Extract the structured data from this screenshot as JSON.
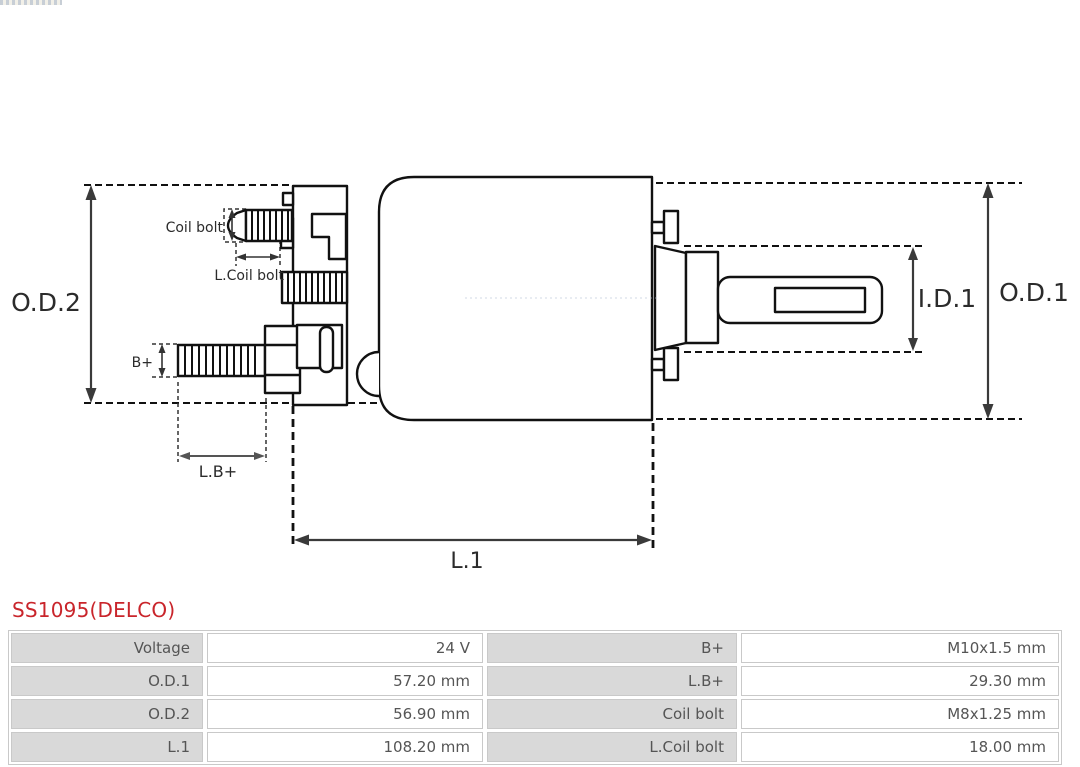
{
  "part": {
    "title": "SS1095(DELCO)",
    "title_color": "#c9252b"
  },
  "diagram": {
    "type": "starter-solenoid technical drawing",
    "labels": {
      "od2": "O.D.2",
      "od1": "O.D.1",
      "id1": "I.D.1",
      "l1": "L.1",
      "lb_plus": "L.B+",
      "b_plus": "B+",
      "coil_bolt": "Coil bolt",
      "l_coil_bolt": "L.Coil bolt"
    },
    "line_color": "#111111",
    "dimension_color": "#3a3a3a"
  },
  "specs_table": {
    "label_bg": "#d9d9d9",
    "border_color": "#c9c9c9",
    "rows": [
      {
        "label_left": "Voltage",
        "value_left": "24 V",
        "label_right": "B+",
        "value_right": "M10x1.5 mm"
      },
      {
        "label_left": "O.D.1",
        "value_left": "57.20 mm",
        "label_right": "L.B+",
        "value_right": "29.30 mm"
      },
      {
        "label_left": "O.D.2",
        "value_left": "56.90 mm",
        "label_right": "Coil bolt",
        "value_right": "M8x1.25 mm"
      },
      {
        "label_left": "L.1",
        "value_left": "108.20 mm",
        "label_right": "L.Coil bolt",
        "value_right": "18.00 mm"
      }
    ]
  }
}
